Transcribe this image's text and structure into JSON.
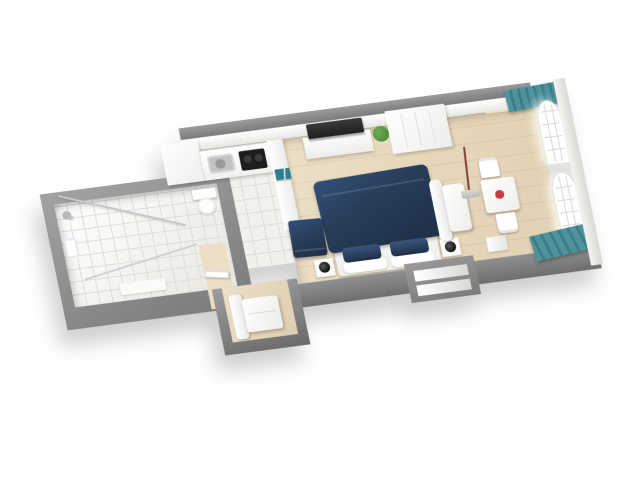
{
  "scene": {
    "title": "3D studio apartment floor plan render",
    "view": "isometric top-down 3D cutaway, white background",
    "background": "#ffffff",
    "colors": {
      "wall-top": "#909090",
      "wall-side": "#7a7a7a",
      "wall-face": "#f5f5f3",
      "floor-wood": "#ecdfc6",
      "floor-wood-deep": "#e2d1b3",
      "floor-tile": "#f1f1ee",
      "tile-line": "#dedeD9",
      "navy": "#283d59",
      "navy-dark": "#1e2f46",
      "teal": "#4f939d",
      "teal-dark": "#3e7d88",
      "art-teal": "#2e7d8c",
      "steel": "#c2c2c2",
      "cooktop": "#1d1d1d",
      "tv": "#1f1f1f",
      "plant": "#4c8f3a",
      "flower-red": "#cf3a3f",
      "lamp-rod": "#8a4030"
    },
    "rooms": [
      {
        "name": "bathroom",
        "floor": "white tile",
        "features": [
          "walk-in shower with glass partition",
          "shower head",
          "toilet",
          "wash basin",
          "bath mat"
        ]
      },
      {
        "name": "kitchen",
        "floor": "white tile",
        "features": [
          "tall white cabinet",
          "white counter",
          "stainless steel sink",
          "two-burner black cooktop",
          "low partition wall with teal artwork"
        ]
      },
      {
        "name": "living-bedroom",
        "floor": "light wood",
        "features": [
          "white tv console",
          "black flat tv",
          "green potted plant",
          "white wardrobe",
          "double bed with navy duvet",
          "two navy pillows",
          "two white pillows",
          "two white nightstands",
          "two black bedside lamps",
          "navy cube chair",
          "white armchair in alcove",
          "recessed wall shelf niche",
          "entrance door"
        ]
      },
      {
        "name": "window-nook",
        "floor": "light wood",
        "features": [
          "white bench sofa",
          "red-brown floor lamp",
          "white dining table",
          "red flowers",
          "two white chairs",
          "small white shelf",
          "two arched grid windows",
          "teal curtains north",
          "teal curtain bundle south"
        ]
      }
    ]
  }
}
